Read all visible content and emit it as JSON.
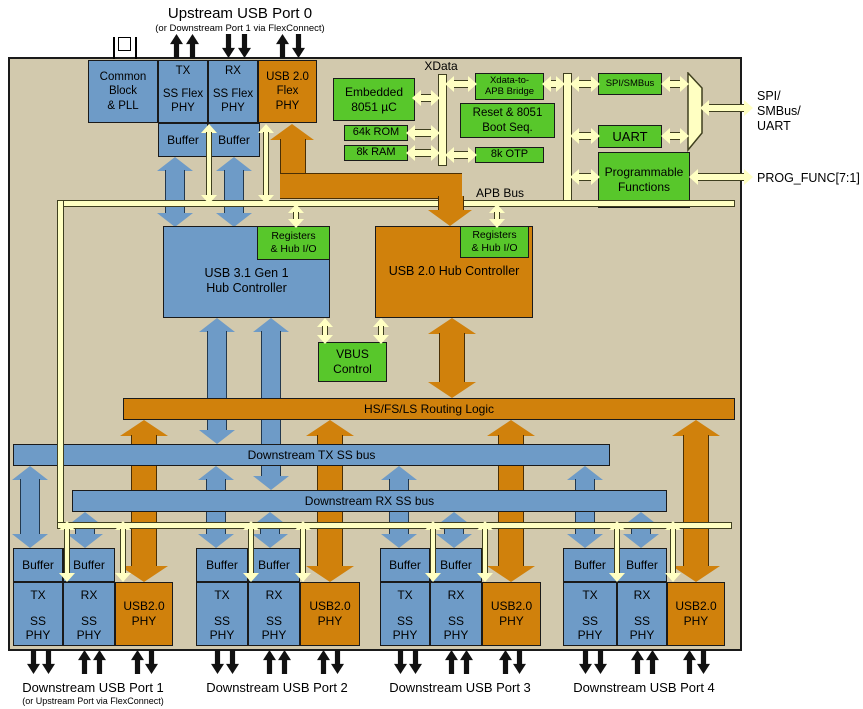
{
  "colors": {
    "chip_bg": "#d2c9ad",
    "blue": "#6e9bc7",
    "orange": "#d0810c",
    "green": "#58c72b",
    "bus_yellow": "#ffffc2"
  },
  "header": {
    "title": "Upstream USB Port 0",
    "subtitle": "(or Downstream Port 1 via FlexConnect)"
  },
  "upstream_phy": {
    "common_pll": "Common\nBlock\n& PLL",
    "tx": "TX",
    "rx": "RX",
    "ss_flex": "SS Flex\nPHY",
    "usb2_flex": "USB 2.0\nFlex\nPHY",
    "buffer": "Buffer"
  },
  "mcu": {
    "embedded": "Embedded\n8051 µC",
    "rom": "64k ROM",
    "ram": "8k RAM",
    "xdata_label": "XData",
    "bridge": "Xdata-to-\nAPB Bridge",
    "reset": "Reset & 8051\nBoot Seq.",
    "otp": "8k OTP",
    "apb_label": "APB Bus"
  },
  "peripherals": {
    "spi": "SPI/SMBus",
    "uart": "UART",
    "prog": "Programmable\nFunctions",
    "io_spi": "SPI/\nSMBus/\nUART",
    "io_prog": "PROG_FUNC[7:1]"
  },
  "hubs": {
    "usb31": "USB 3.1 Gen 1\nHub Controller",
    "usb2": "USB 2.0 Hub Controller",
    "registers": "Registers\n& Hub I/O",
    "vbus": "VBUS\nControl"
  },
  "buses": {
    "routing": "HS/FS/LS Routing Logic",
    "tx_ss": "Downstream TX SS bus",
    "rx_ss": "Downstream RX SS bus"
  },
  "port_cell": {
    "buffer": "Buffer",
    "tx": "TX",
    "rx": "RX",
    "ss_phy": "SS\nPHY",
    "usb2_phy": "USB2.0\nPHY"
  },
  "ports": [
    {
      "label": "Downstream USB Port 1",
      "sub": "(or Upstream Port via FlexConnect)"
    },
    {
      "label": "Downstream USB Port 2"
    },
    {
      "label": "Downstream USB Port 3"
    },
    {
      "label": "Downstream USB Port 4"
    }
  ]
}
